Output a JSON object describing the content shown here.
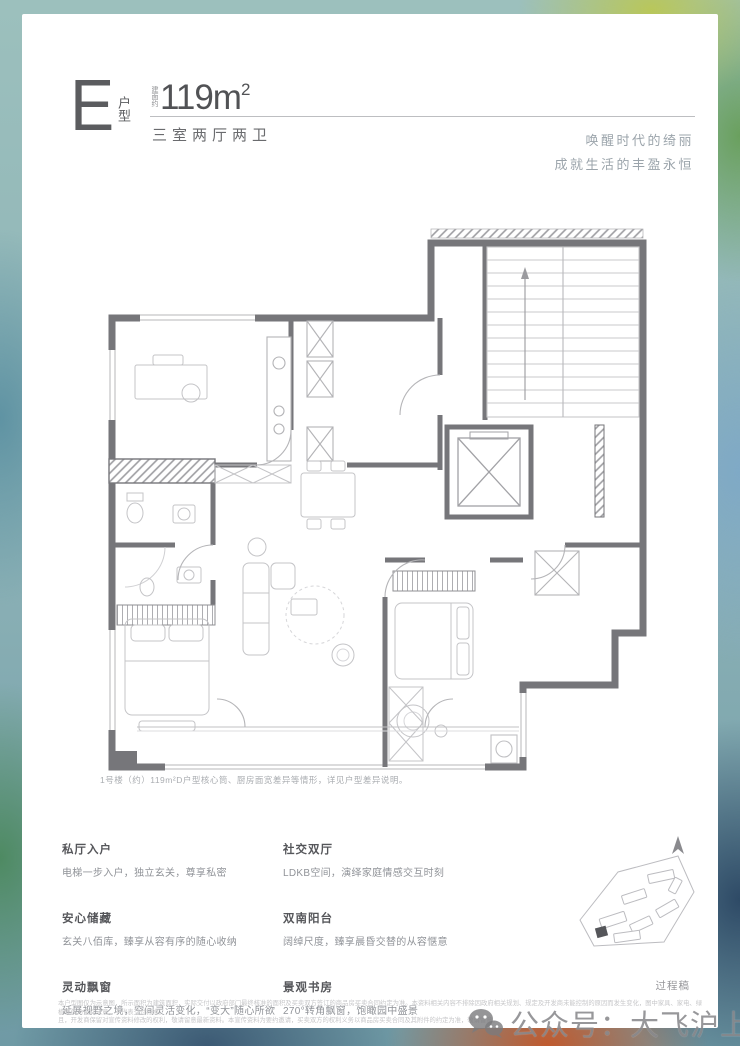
{
  "colors": {
    "accent": "#5b5c5f",
    "muted": "#9ba4ab",
    "wall": "#76767a",
    "highlight_building": "#55565a"
  },
  "header": {
    "unit_letter": "E",
    "unit_type_label": "户型",
    "area_prefix": "建面约",
    "area_value": "119m",
    "area_sup": "2",
    "layout_text": "三室两厅两卫",
    "slogan_line1": "唤醒时代的绮丽",
    "slogan_line2": "成就生活的丰盈永恒"
  },
  "floorplan": {
    "note": "1号楼（约）119m²D户型核心筒、厨房面宽差异等情形，详见户型差异说明。",
    "rooms": [
      "书房",
      "厨房",
      "楼梯间",
      "电梯",
      "餐厅",
      "客厅",
      "主卧",
      "卫生间",
      "次卧",
      "双南阳台"
    ]
  },
  "features": {
    "left": [
      {
        "title": "私厅入户",
        "desc": "电梯一步入户，独立玄关，尊享私密"
      },
      {
        "title": "安心储藏",
        "desc": "玄关八佰库，臻享从容有序的随心收纳"
      },
      {
        "title": "灵动飘窗",
        "desc": "延展视野之境，空间灵活变化，“变大”随心所欲"
      }
    ],
    "right": [
      {
        "title": "社交双厅",
        "desc": "LDKB空间，演绎家庭情感交互时刻"
      },
      {
        "title": "双南阳台",
        "desc": "阔绰尺度，臻享晨昏交替的从容惬意"
      },
      {
        "title": "景观书房",
        "desc": "270°转角飘窗，饱瞰园中盛景"
      }
    ]
  },
  "sitemap": {
    "draft_label": "过程稿",
    "north_icon": "north-arrow-icon"
  },
  "disclaimer": {
    "line1": "本户型图仅为示意图，所示面积为建筑面积，实际交付以政府部门最终核准的面积及买卖双方签订的商品房买卖合同约定为准。本资料相关内容不排除因政府相关规划、规定及开发商未能控制的原因而发生变化，图中家具、家电、绿植等仅为空间示意，不代表交付标准。",
    "line2": "且，开发商保留对宣传资料修改的权利，敬请留意最新资料。本宣传资料为要约邀请，买卖双方的权利义务以商品房买卖合同及其附件的约定为准，敬请留意。"
  },
  "watermark": {
    "icon": "wechat-icon",
    "text": "公众号：大飞沪上探房"
  }
}
